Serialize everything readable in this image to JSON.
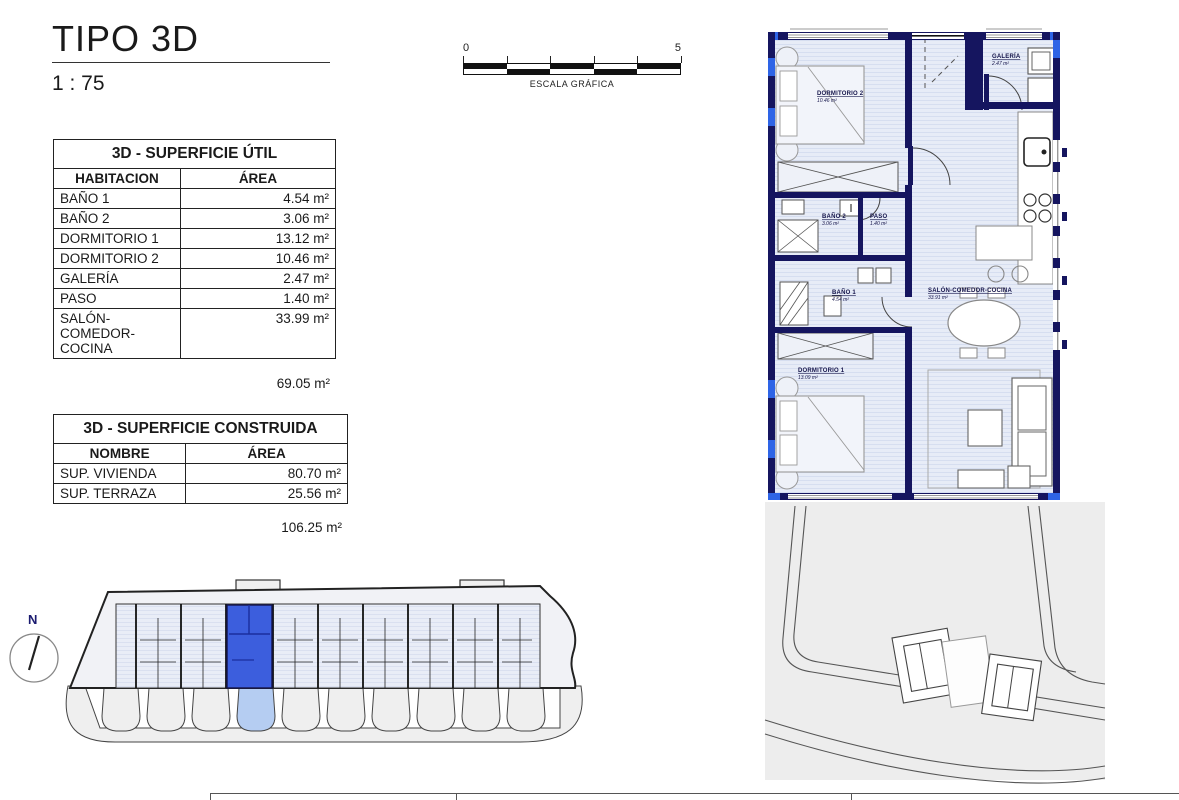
{
  "header": {
    "title": "TIPO 3D",
    "scale": "1 : 75"
  },
  "scalebar": {
    "start": "0",
    "end": "5",
    "label": "ESCALA GRÁFICA"
  },
  "north": {
    "label": "N"
  },
  "tables": {
    "util": {
      "title": "3D - SUPERFICIE ÚTIL",
      "col1": "HABITACION",
      "col2": "ÁREA",
      "rows": [
        {
          "name": "BAÑO 1",
          "area": "4.54 m²"
        },
        {
          "name": "BAÑO 2",
          "area": "3.06 m²"
        },
        {
          "name": "DORMITORIO 1",
          "area": "13.12 m²"
        },
        {
          "name": "DORMITORIO 2",
          "area": "10.46 m²"
        },
        {
          "name": "GALERÍA",
          "area": "2.47 m²"
        },
        {
          "name": "PASO",
          "area": "1.40 m²"
        },
        {
          "name": "SALÓN-COMEDOR-COCINA",
          "area": "33.99 m²"
        }
      ],
      "total": "69.05 m²"
    },
    "construida": {
      "title": "3D - SUPERFICIE CONSTRUIDA",
      "col1": "NOMBRE",
      "col2": "ÁREA",
      "rows": [
        {
          "name": "SUP. VIVIENDA",
          "area": "80.70 m²"
        },
        {
          "name": "SUP. TERRAZA",
          "area": "25.56 m²"
        }
      ],
      "total": "106.25 m²"
    }
  },
  "plan": {
    "rooms": {
      "dormitorio2": {
        "name": "DORMITORIO 2",
        "area": "10.46 m²"
      },
      "galeria": {
        "name": "GALERÍA",
        "area": "2.47 m²"
      },
      "bano2": {
        "name": "BAÑO 2",
        "area": "3.06 m²"
      },
      "paso": {
        "name": "PASO",
        "area": "1.40 m²"
      },
      "bano1": {
        "name": "BAÑO 1",
        "area": "4.54 m²"
      },
      "salon": {
        "name": "SALÓN-COMEDOR-COCINA",
        "area": "33.91 m²"
      },
      "dormitorio1": {
        "name": "DORMITORIO 1",
        "area": "13.09 m²"
      }
    }
  },
  "colors": {
    "wall_navy": "#15155f",
    "window_blue": "#2e64e6",
    "floor_light": "#e7ecf7",
    "highlight_unit": "#3c5edd",
    "highlight_terrace": "#b5cdf2",
    "site_gray": "#efefef"
  }
}
